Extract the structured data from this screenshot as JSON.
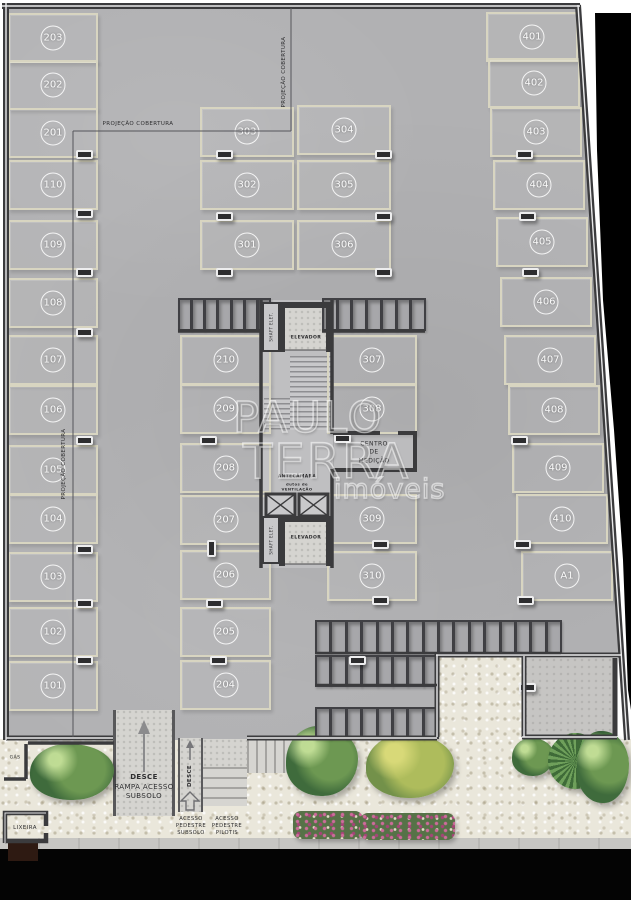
{
  "plan": {
    "projection_label": "PROJEÇÃO COBERTURA",
    "watermark": {
      "line1": "PAULO",
      "line2": "TERRA",
      "line3": "imóveis"
    },
    "parking": {
      "left_column": [
        "203",
        "202",
        "201",
        "110",
        "109",
        "108",
        "107",
        "106",
        "105",
        "104",
        "103",
        "102",
        "101"
      ],
      "mid_left_upper": [
        "303",
        "302",
        "301"
      ],
      "mid_right_upper": [
        "304",
        "305",
        "306"
      ],
      "mid_left_lower": [
        "210",
        "209",
        "208",
        "207",
        "206",
        "205",
        "204"
      ],
      "mid_right_lower": [
        "307",
        "308",
        "309",
        "310"
      ],
      "right_column": [
        "401",
        "402",
        "403",
        "404",
        "405",
        "406",
        "407",
        "408",
        "409",
        "410",
        "A1"
      ]
    },
    "core": {
      "shaft_top": "SHAFT ELET.",
      "elevator_top": "ELEVADOR",
      "antechamber": "ANTECÂMARA",
      "ducts_line1": "dutos de",
      "ducts_line2": "VENTILAÇÃO",
      "shaft_bottom": "SHAFT ELET.",
      "elevator_bottom": "ELEVADOR",
      "metering": [
        "CENTRO",
        "DE",
        "MEDIÇÃO"
      ]
    },
    "outdoor": {
      "ramp": [
        "DESCE",
        "RAMPA ACESSO",
        "SUBSOLO"
      ],
      "walkway": "DESCE",
      "access_left": [
        "ACESSO",
        "PEDESTRE",
        "SUBSOLO"
      ],
      "access_right": [
        "ACESSO",
        "PEDESTRE",
        "PILOTIS"
      ],
      "gas": "GÁS",
      "trash": "LIXEIRA"
    }
  }
}
